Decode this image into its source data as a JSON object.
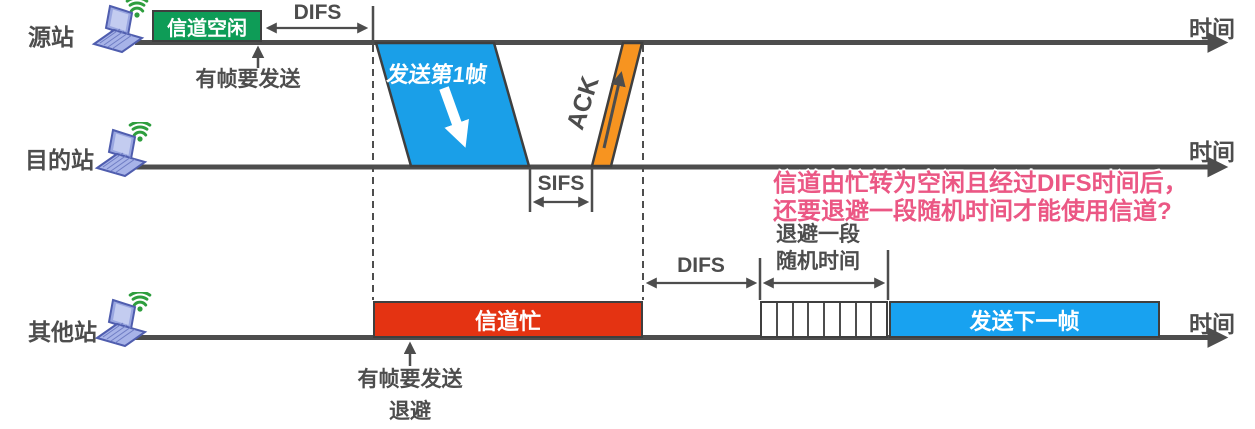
{
  "stations": [
    {
      "id": "source",
      "label": "源站",
      "time_label": "时间"
    },
    {
      "id": "destination",
      "label": "目的站",
      "time_label": "时间"
    },
    {
      "id": "other",
      "label": "其他站",
      "time_label": "时间"
    }
  ],
  "source_row": {
    "channel_idle": "信道空闲",
    "difs": "DIFS",
    "frame_arrives": "有帧要发送",
    "send_first_frame": "发送第1帧",
    "ack": "ACK"
  },
  "destination_row": {
    "sifs": "SIFS"
  },
  "other_row": {
    "channel_busy": "信道忙",
    "difs": "DIFS",
    "backoff_line1": "退避一段",
    "backoff_line2": "随机时间",
    "backoff_slots": 8,
    "send_next_frame": "发送下一帧",
    "frame_arrives": "有帧要发送",
    "backoff": "退避"
  },
  "annotation": {
    "line1": "信道由忙转为空闲且经过DIFS时间后，",
    "line2": "还要退避一段随机时间才能使用信道?"
  },
  "colors": {
    "channel_idle_green": "#0e9c57",
    "data_frame_blue": "#1a9fe8",
    "ack_orange": "#f79420",
    "channel_busy_red": "#e43312",
    "next_frame_blue": "#18a2f0",
    "line_gray": "#4d4d4d",
    "note_pink": "#eb5784",
    "laptop_purple": "#a7b3e8",
    "wifi_green": "#2e9e3e"
  }
}
